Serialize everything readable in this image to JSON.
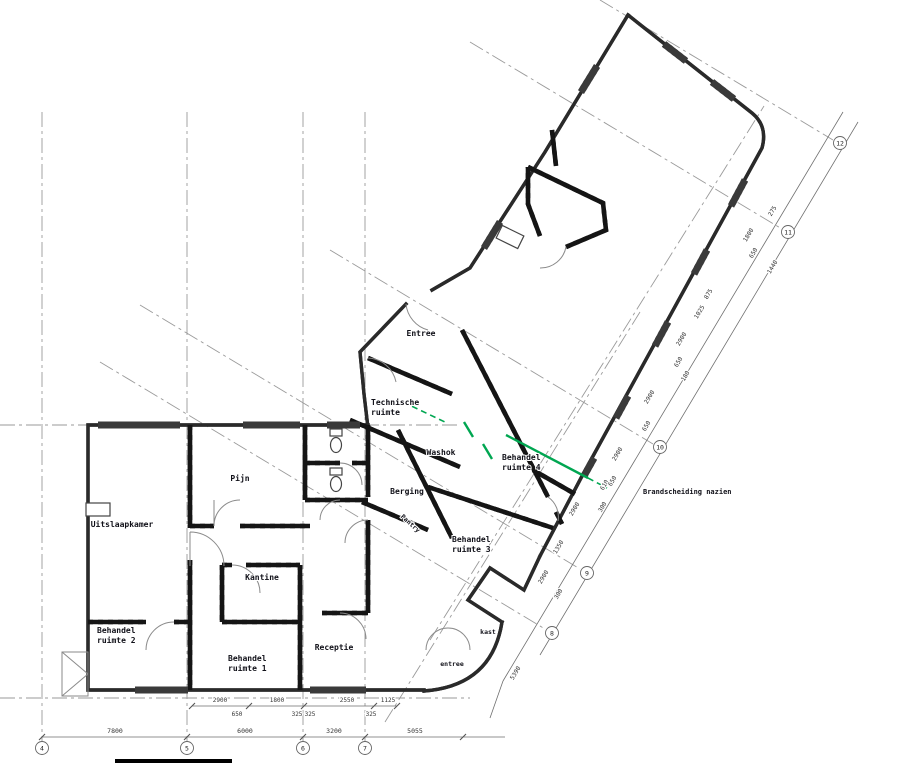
{
  "colors": {
    "wall": "#2a2a2a",
    "grid_line": "#9a9a9a",
    "green_marking": "#00a651",
    "dim_text": "#333333"
  },
  "rooms": [
    {
      "id": "uitslaapkamer",
      "label": "Uitslaapkamer",
      "x": 122,
      "y": 527
    },
    {
      "id": "pijn",
      "label": "Pijn",
      "x": 240,
      "y": 481
    },
    {
      "id": "behandel-ruimte-2",
      "label": "Behandel\nruimte 2",
      "x": 97,
      "y": 633,
      "anchor": "start"
    },
    {
      "id": "kantine",
      "label": "Kantine",
      "x": 262,
      "y": 580
    },
    {
      "id": "behandel-ruimte-1",
      "label": "Behandel\nruimte 1",
      "x": 228,
      "y": 661,
      "anchor": "start"
    },
    {
      "id": "receptie",
      "label": "Receptie",
      "x": 334,
      "y": 650
    },
    {
      "id": "entree-main",
      "label": "Entree",
      "x": 421,
      "y": 336
    },
    {
      "id": "technische-ruimte",
      "label": "Technische\nruimte",
      "x": 371,
      "y": 405,
      "anchor": "start"
    },
    {
      "id": "washok",
      "label": "Washok",
      "x": 441,
      "y": 455
    },
    {
      "id": "berging",
      "label": "Berging",
      "x": 407,
      "y": 494
    },
    {
      "id": "pantry",
      "label": "Pantry",
      "x": 409,
      "y": 525,
      "rot": 42,
      "small": true
    },
    {
      "id": "behandel-ruimte-4",
      "label": "Behandel\nruimte 4",
      "x": 502,
      "y": 460,
      "anchor": "start"
    },
    {
      "id": "behandel-ruimte-3",
      "label": "Behandel\nruimte 3",
      "x": 452,
      "y": 542,
      "anchor": "start"
    },
    {
      "id": "kast",
      "label": "kast",
      "x": 488,
      "y": 634,
      "small": true
    },
    {
      "id": "entree-lower",
      "label": "entree",
      "x": 452,
      "y": 666,
      "small": true
    }
  ],
  "annotations": [
    {
      "id": "brandscheiding",
      "label": "Brandscheiding nazien",
      "x": 643,
      "y": 494
    }
  ],
  "grid": {
    "bottom_y": 748,
    "bottom": [
      {
        "n": "4",
        "x": 42
      },
      {
        "n": "5",
        "x": 187
      },
      {
        "n": "6",
        "x": 303
      },
      {
        "n": "7",
        "x": 365
      }
    ],
    "diagonal": [
      {
        "n": "8",
        "x": 552,
        "y": 633
      },
      {
        "n": "9",
        "x": 587,
        "y": 573
      },
      {
        "n": "10",
        "x": 660,
        "y": 447
      },
      {
        "n": "11",
        "x": 788,
        "y": 232
      },
      {
        "n": "12",
        "x": 840,
        "y": 143
      }
    ]
  },
  "dimensions": {
    "bottom_main": [
      {
        "v": "7800",
        "x": 115,
        "y": 733
      },
      {
        "v": "6000",
        "x": 245,
        "y": 733
      },
      {
        "v": "3200",
        "x": 334,
        "y": 733
      },
      {
        "v": "5055",
        "x": 415,
        "y": 733
      }
    ],
    "bottom_secondary": [
      {
        "v": "2900",
        "x": 220,
        "y": 702
      },
      {
        "v": "1800",
        "x": 277,
        "y": 702
      },
      {
        "v": "2550",
        "x": 347,
        "y": 702
      },
      {
        "v": "1125",
        "x": 388,
        "y": 702
      }
    ],
    "bottom_boxed": [
      {
        "v": "650",
        "x": 237,
        "y": 716
      },
      {
        "v": "325",
        "x": 297,
        "y": 716
      },
      {
        "v": "325",
        "x": 310,
        "y": 716
      },
      {
        "v": "325",
        "x": 371,
        "y": 716
      }
    ],
    "diagonal": [
      {
        "v": "275",
        "x": 774,
        "y": 212
      },
      {
        "v": "1800",
        "x": 750,
        "y": 236
      },
      {
        "v": "650",
        "x": 755,
        "y": 254
      },
      {
        "v": "1440",
        "x": 774,
        "y": 268
      },
      {
        "v": "875",
        "x": 710,
        "y": 295
      },
      {
        "v": "1025",
        "x": 701,
        "y": 313
      },
      {
        "v": "2900",
        "x": 683,
        "y": 340
      },
      {
        "v": "650",
        "x": 680,
        "y": 363
      },
      {
        "v": "180",
        "x": 687,
        "y": 377
      },
      {
        "v": "2900",
        "x": 651,
        "y": 398
      },
      {
        "v": "650",
        "x": 648,
        "y": 427
      },
      {
        "v": "610",
        "x": 606,
        "y": 486
      },
      {
        "v": "2900",
        "x": 619,
        "y": 455
      },
      {
        "v": "650",
        "x": 614,
        "y": 482
      },
      {
        "v": "300",
        "x": 604,
        "y": 508
      },
      {
        "v": "2900",
        "x": 576,
        "y": 510
      },
      {
        "v": "1350",
        "x": 560,
        "y": 548
      },
      {
        "v": "2900",
        "x": 545,
        "y": 578
      },
      {
        "v": "300",
        "x": 560,
        "y": 595
      },
      {
        "v": "5390",
        "x": 517,
        "y": 674
      }
    ]
  }
}
